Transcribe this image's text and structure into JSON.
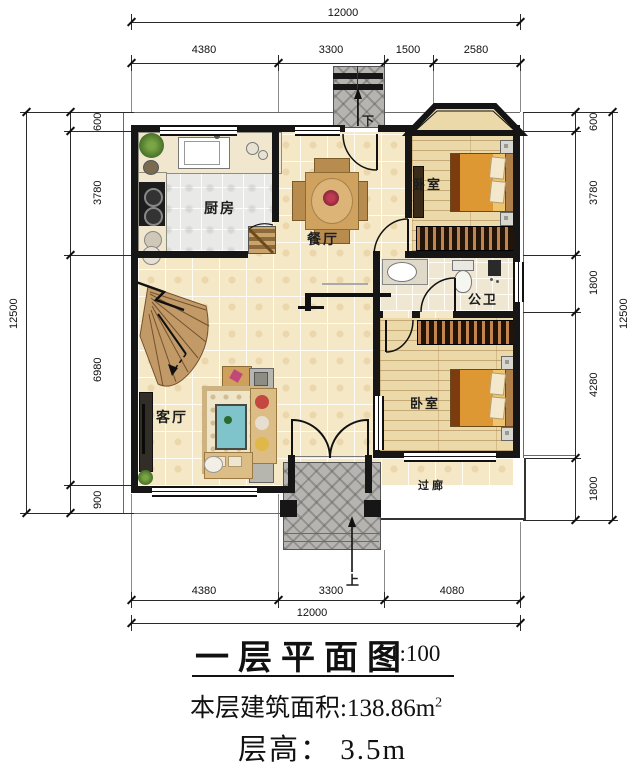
{
  "title_block": {
    "title": "一层平面图",
    "scale": "1:100",
    "area": "本层建筑面积:138.86m",
    "area_sup": "2",
    "floor_height": "层高： 3.5m"
  },
  "dimensions": {
    "top": {
      "overall": "12000",
      "segments": [
        "4380",
        "3300",
        "1500",
        "2580"
      ]
    },
    "bottom": {
      "overall": "12000",
      "segments": [
        "4380",
        "3300",
        "4080"
      ]
    },
    "left": {
      "overall": "12500",
      "segments": [
        "600",
        "3780",
        "6980",
        "900"
      ]
    },
    "right": {
      "overall": "12500",
      "segments": [
        "600",
        "3780",
        "1800",
        "4280",
        "1800"
      ]
    }
  },
  "rooms": {
    "kitchen": "厨房",
    "dining": "餐厅",
    "bedroom_top": "卧室",
    "bathroom": "公卫",
    "bedroom_bottom": "卧室",
    "living": "客厅",
    "corridor": "过廊"
  },
  "stair_annotations": {
    "down": "下",
    "up": "上"
  },
  "colors": {
    "wall": "#161616",
    "cream_tile": "#f5e8c6",
    "kitchen_tile": "#e9eae8",
    "wood_floor": "#ecd9a9",
    "bath_tile": "#efe7d2",
    "porch_tile": "#b6b4b0",
    "bed_orange": "#dd9833",
    "stair_wood": "#c29a68"
  }
}
